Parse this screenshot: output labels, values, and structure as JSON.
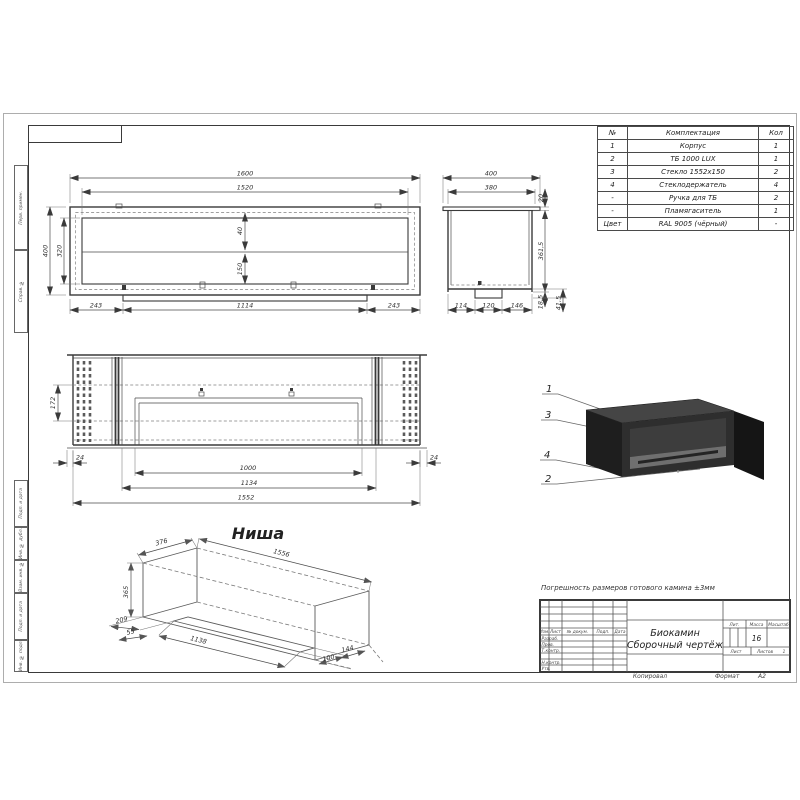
{
  "parts_table": {
    "headers": [
      "№",
      "Комплектация",
      "Кол"
    ],
    "rows": [
      [
        "1",
        "Корпус",
        "1"
      ],
      [
        "2",
        "ТБ 1000 LUX",
        "1"
      ],
      [
        "3",
        "Стекло 1552x150",
        "2"
      ],
      [
        "4",
        "Стеклодержатель",
        "4"
      ],
      [
        "-",
        "Ручка для ТБ",
        "2"
      ],
      [
        "-",
        "Пламягаситель",
        "1"
      ],
      [
        "Цвет",
        "RAL 9005 (чёрный)",
        "-"
      ]
    ]
  },
  "front_view": {
    "dims": {
      "w_outer": "1600",
      "w_inner": "1520",
      "h_outer": "400",
      "h_inner": "320",
      "top_gap": "40",
      "glass_h": "150",
      "b_left": "243",
      "b_mid": "1114",
      "b_right": "243"
    }
  },
  "side_view": {
    "dims": {
      "w_outer": "400",
      "w_inner": "380",
      "flange": "20",
      "height": "361,5",
      "b1": "114",
      "b2": "120",
      "b3": "146",
      "r1": "18,5",
      "r2": "41,5"
    }
  },
  "plan_view": {
    "dims": {
      "h_left": "172",
      "off_l": "24",
      "burner": "1000",
      "inner": "1134",
      "base": "1552",
      "off_r": "24"
    }
  },
  "iso_view": {
    "callouts": [
      "1",
      "3",
      "4",
      "2"
    ]
  },
  "niche": {
    "title": "Ниша",
    "dims": {
      "depth": "376",
      "length": "1556",
      "height": "365",
      "d209": "209",
      "d55": "55",
      "d1138": "1138",
      "d100": "100",
      "d144": "144"
    }
  },
  "note": "Погрешность размеров готового камина ±3мм",
  "title_block": {
    "title_line1": "Биокамин",
    "title_line2": "Сборочный чертёж",
    "col_izm": "Изм.",
    "col_list": "Лист",
    "col_doc": "№ докум.",
    "col_podp": "Подп.",
    "col_data": "Дата",
    "row_razrab": "Разраб.",
    "row_prov": "Пров.",
    "row_tkontr": "Т.контр.",
    "row_nkontr": "Н.контр.",
    "row_utv": "Утв.",
    "lit": "Лит.",
    "massa": "Масса",
    "masshtab": "Масштаб",
    "massa_value": "16",
    "list": "Лист",
    "listov": "Листов",
    "listov_value": "1",
    "kopiroval": "Копировал",
    "format_label": "Формат",
    "format_value": "А2"
  },
  "margin": {
    "perv": "Перв. примен.",
    "sprav": "Справ. №",
    "podp1": "Подп. и дата",
    "inv_dubl": "Инв. № дубл.",
    "vzam": "Взам. инв. №",
    "podp2": "Подп. и дата",
    "inv_podl": "Инв. № подл."
  },
  "colors": {
    "line": "#3a3a3a",
    "body_dark": "#1e1e1e",
    "dim_text": "#2f2f2f"
  }
}
